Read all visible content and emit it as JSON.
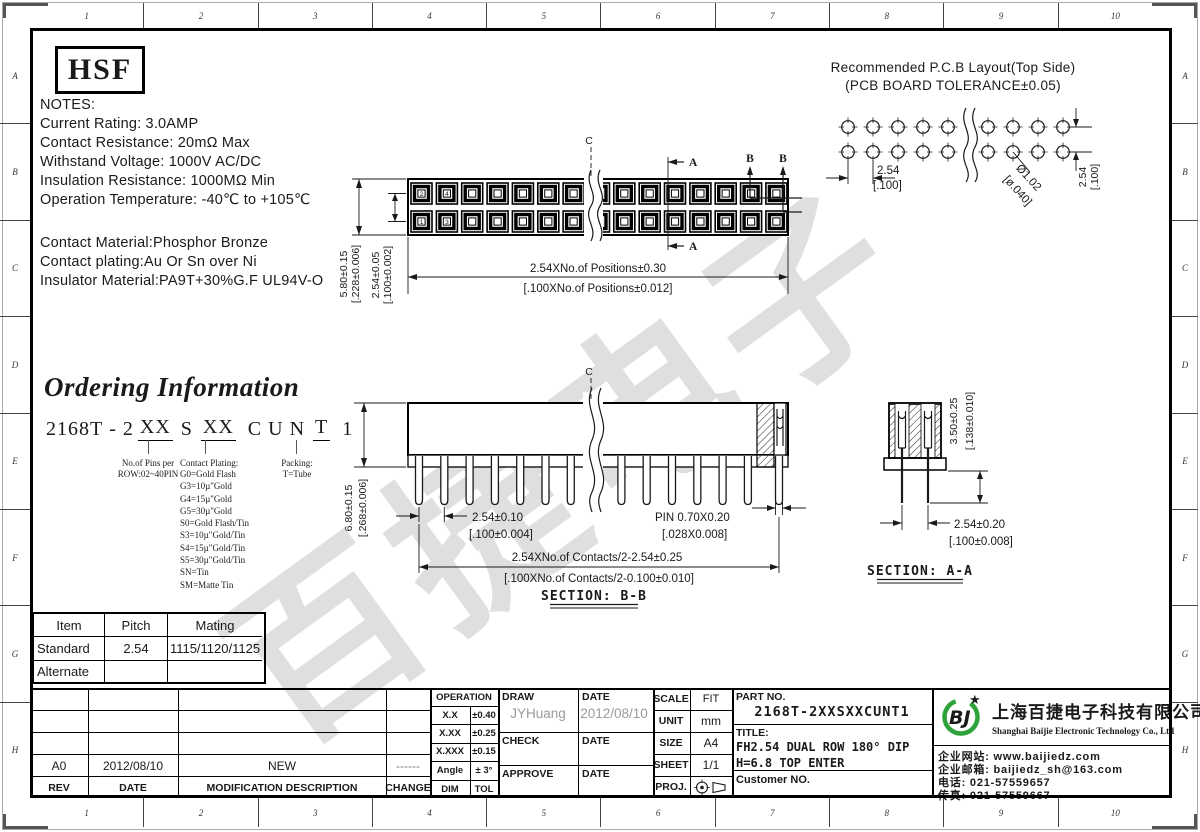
{
  "colors": {
    "line": "#1a1a1a",
    "logo_green": "#2fa23c",
    "logo_blue": "#1565ad",
    "star_blue": "#1d3f96",
    "watermark_gray": "#d9d9d9",
    "handwriting_gray": "#9a9a9a"
  },
  "border": {
    "cols": [
      "1",
      "2",
      "3",
      "4",
      "5",
      "6",
      "7",
      "8",
      "9",
      "10"
    ],
    "rows": [
      "A",
      "B",
      "C",
      "D",
      "E",
      "F",
      "G",
      "H"
    ]
  },
  "logo_box": {
    "text": "HSF"
  },
  "notes": {
    "title_lines": [
      "NOTES:",
      "Current Rating: 3.0AMP",
      "Contact Resistance: 20mΩ Max",
      "Withstand Voltage: 1000V AC/DC",
      "Insulation Resistance: 1000MΩ Min",
      "Operation Temperature: -40℃ to +105℃"
    ],
    "material_lines": [
      "Contact Material:Phosphor Bronze",
      "Contact plating:Au Or Sn over Ni",
      "Insulator Material:PA9T+30%G.F UL94V-O"
    ]
  },
  "pcb": {
    "title1": "Recommended P.C.B Layout(Top Side)",
    "title2": "(PCB BOARD TOLERANCE±0.05)",
    "pitch": "2.54",
    "pitch_in": "[.100]",
    "hole": "Ø1.02",
    "hole_in": "[ø.040]",
    "row": "2.54",
    "row_in": "[.100]"
  },
  "top_view": {
    "centerline": "C",
    "sec_a": "A",
    "sec_b": "B",
    "pins": [
      "2",
      "4",
      "1",
      "3"
    ],
    "h": "5.80±0.15",
    "h_in": "[.228±0.006]",
    "rp": "2.54±0.05",
    "rp_in": "[.100±0.002]",
    "len": "2.54XNo.of Positions±0.30",
    "len_in": "[.100XNo.of Positions±0.012]"
  },
  "ordering": {
    "title": "Ordering Information",
    "p1": "2168T",
    "dash": "-",
    "p2": "2",
    "x1": "XX",
    "s": "S",
    "x2": "XX",
    "c": "C",
    "u": "U",
    "n": "N",
    "t": "T",
    "one": "1",
    "pins_callout": [
      "No.of Pins per",
      "ROW:02~40PIN"
    ],
    "plating_title": "Contact Plating:",
    "plating": [
      "G0=Gold Flash",
      "G3=10µ\"Gold",
      "G4=15µ\"Gold",
      "G5=30µ\"Gold",
      "S0=Gold Flash/Tin",
      "S3=10µ\"Gold/Tin",
      "S4=15µ\"Gold/Tin",
      "S5=30µ\"Gold/Tin",
      "SN=Tin",
      "SM=Matte Tin"
    ],
    "packing": [
      "Packing:",
      "T=Tube"
    ]
  },
  "sec_bb": {
    "centerline": "C",
    "h": "6.80±0.15",
    "h_in": "[.268±0.006]",
    "pitch": "2.54±0.10",
    "pitch_in": "[.100±0.004]",
    "pin": "PIN 0.70X0.20",
    "pin_in": "[.028X0.008]",
    "span": "2.54XNo.of Contacts/2-2.54±0.25",
    "span_in": "[.100XNo.of Contacts/2-0.100±0.010]",
    "label": "SECTION: B-B"
  },
  "sec_aa": {
    "h": "3.50±0.25",
    "h_in": "[.138±0.010]",
    "pitch": "2.54±0.20",
    "pitch_in": "[.100±0.008]",
    "label": "SECTION: A-A"
  },
  "mating": {
    "headers": [
      "Item",
      "Pitch",
      "Mating"
    ],
    "rows": [
      [
        "Standard",
        "2.54",
        "1115/1120/1125"
      ],
      [
        "Alternate",
        "",
        ""
      ]
    ]
  },
  "revision": {
    "headers": [
      "REV",
      "DATE",
      "MODIFICATION DESCRIPTION",
      "CHANGE"
    ],
    "entry": {
      "rev": "A0",
      "date": "2012/08/10",
      "desc": "NEW",
      "change": "------"
    }
  },
  "tolerance": {
    "title": "OPERATION",
    "rows": [
      [
        "X.X",
        "±0.40"
      ],
      [
        "X.XX",
        "±0.25"
      ],
      [
        "X.XXX",
        "±0.15"
      ],
      [
        "Angle",
        "± 3°"
      ],
      [
        "DIM",
        "TOL"
      ]
    ]
  },
  "approval": {
    "draw": "DRAW",
    "date": "DATE",
    "check": "CHECK",
    "approve": "APPROVE",
    "draw_by": "JYHuang",
    "draw_date": "2012/08/10"
  },
  "info": {
    "scale": "SCALE",
    "scale_v": "FIT",
    "unit": "UNIT",
    "unit_v": "mm",
    "size": "SIZE",
    "size_v": "A4",
    "sheet": "SHEET",
    "sheet_v": "1/1",
    "proj": "PROJ."
  },
  "part": {
    "label": "PART NO.",
    "no": "2168T-2XXSXXCUNT1",
    "title_label": "TITLE:",
    "title1": "FH2.54 DUAL ROW 180° DIP",
    "title2": "H=6.8 TOP ENTER",
    "customer": "Customer NO."
  },
  "company": {
    "logo": "BJ",
    "star": "★",
    "cn": "上海百捷电子科技有限公司",
    "en": "Shanghai Baijie Electronic Technology Co., Ltd",
    "website": "企业网站: www.baijiedz.com",
    "email": "企业邮箱: baijiedz_sh@163.com",
    "tel": "电话: 021-57559657",
    "fax": "传真: 021-57559667"
  },
  "watermark": "百捷电子"
}
